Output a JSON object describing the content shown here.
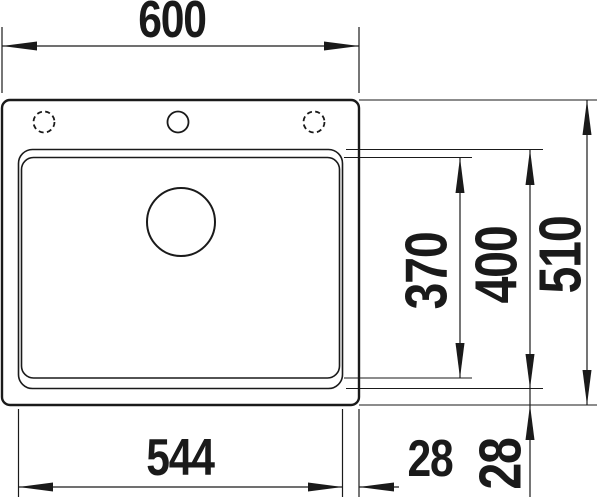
{
  "drawing": {
    "colors": {
      "line": "#1a1a1a",
      "background": "#ffffff"
    }
  },
  "dims": {
    "total_width": {
      "label": "600",
      "orientation": "horizontal"
    },
    "rim_width": {
      "label": "544",
      "orientation": "horizontal"
    },
    "margin_right": {
      "label": "28",
      "orientation": "horizontal"
    },
    "bowl_depth": {
      "label": "370",
      "orientation": "vertical"
    },
    "rim_depth": {
      "label": "400",
      "orientation": "vertical"
    },
    "total_depth": {
      "label": "510",
      "orientation": "vertical"
    },
    "margin_front": {
      "label": "28",
      "orientation": "vertical"
    }
  }
}
